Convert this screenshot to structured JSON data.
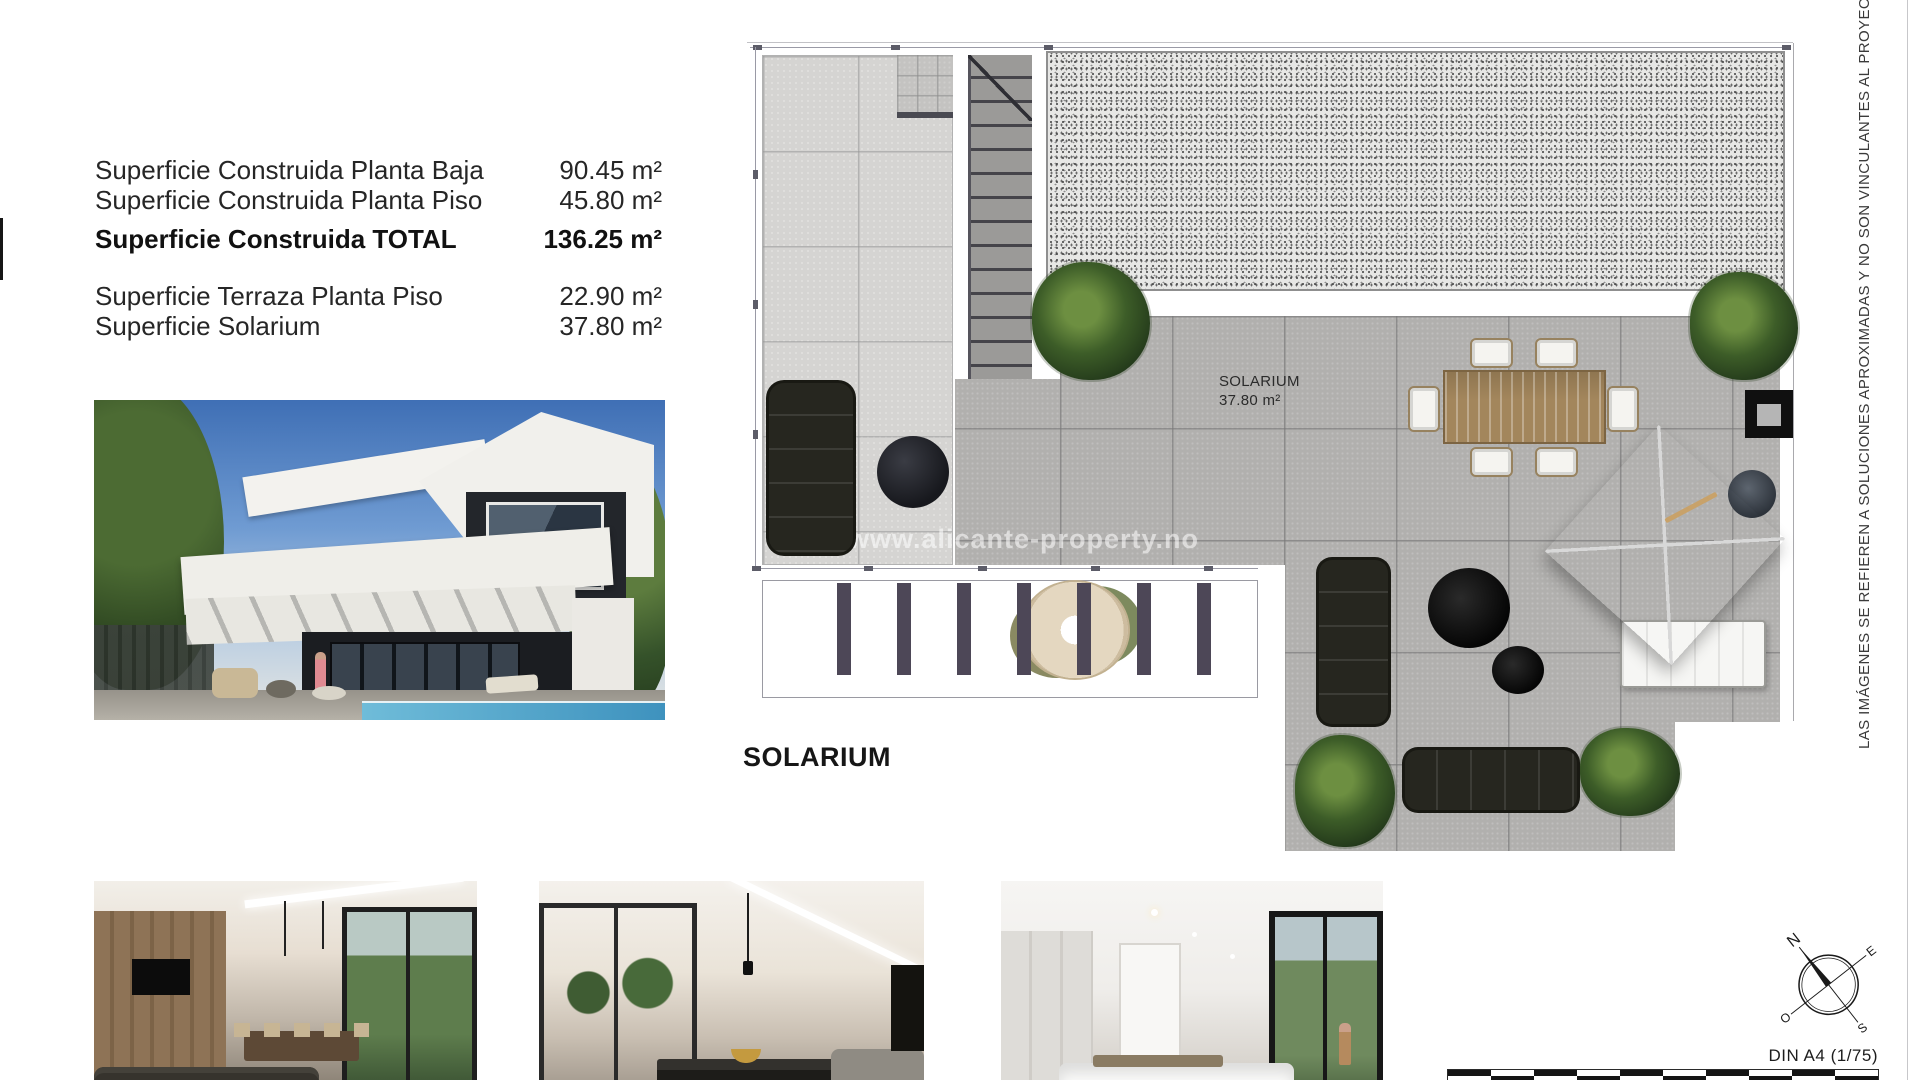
{
  "colors": {
    "paper": "#ffffff",
    "text": "#262626",
    "tile_light": "#d5d4d2",
    "tile_dark": "#b1b0ae",
    "wood": "#a3865c",
    "plant_green": "#3d5d28"
  },
  "spec": {
    "rows": [
      {
        "label": "Superficie Construida Planta Baja",
        "value": "90.45 m²"
      },
      {
        "label": "Superficie Construida Planta Piso",
        "value": "45.80 m²"
      },
      {
        "label": "Superficie Construida TOTAL",
        "value": "136.25 m²"
      },
      {
        "label": "Superficie Terraza Planta Piso",
        "value": "22.90 m²"
      },
      {
        "label": "Superficie Solarium",
        "value": "37.80 m²"
      }
    ]
  },
  "plan": {
    "title": "SOLARIUM",
    "room_name": "SOLARIUM",
    "room_area": "37.80 m²",
    "watermark": "www.alicante-property.no"
  },
  "side_note": "LAS IMÁGENES SE REFIEREN A SOLUCIONES APROXIMADAS Y NO SON VINCULANTES AL PROYECTO FINAL",
  "footer": {
    "scale_label": "DIN A4 (1/75)",
    "compass": {
      "n": "N",
      "e": "E",
      "s": "S",
      "o": "O"
    }
  }
}
